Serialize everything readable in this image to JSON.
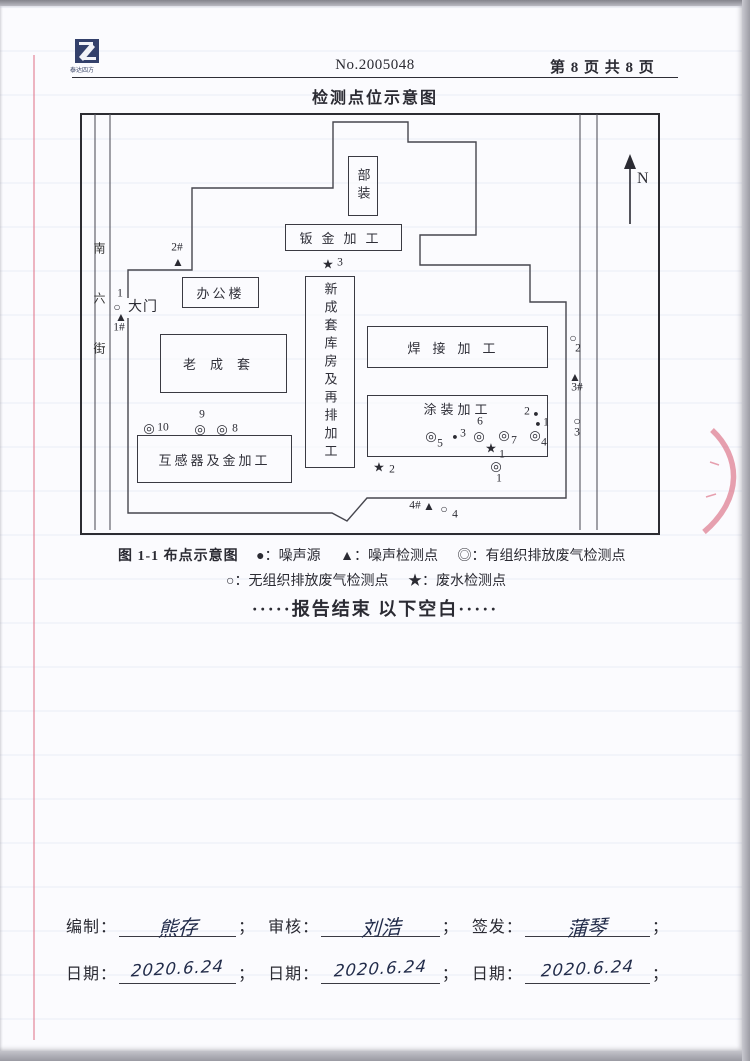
{
  "header": {
    "logo_text": "泰达四方",
    "doc_no": "No.2005048",
    "page_info": "第 8 页 共 8 页",
    "title": "检测点位示意图"
  },
  "diagram": {
    "north_label": "N",
    "street_name": "南六街",
    "gate_label": "大门",
    "symbols": {
      "noise_source": "●",
      "noise_point": "▲",
      "organized_gas": "◎",
      "unorganized_gas": "○",
      "wastewater": "★"
    },
    "buildings": [
      {
        "id": "buzhuang",
        "label": "部装",
        "x": 348,
        "y": 156,
        "w": 30,
        "h": 60,
        "vertical": true
      },
      {
        "id": "banjin",
        "label": "钣金加工",
        "x": 285,
        "y": 224,
        "w": 117,
        "h": 27,
        "spacing": 9
      },
      {
        "id": "bangonglou",
        "label": "办公楼",
        "x": 182,
        "y": 277,
        "w": 77,
        "h": 31,
        "spacing": 3
      },
      {
        "id": "xinchengtao",
        "label": "新成套库房及再排加工",
        "x": 305,
        "y": 276,
        "w": 50,
        "h": 192,
        "vertical": true
      },
      {
        "id": "laochengtao",
        "label": "老成套",
        "x": 160,
        "y": 334,
        "w": 127,
        "h": 59,
        "spacing": 14
      },
      {
        "id": "hanjie",
        "label": "焊接加工",
        "x": 367,
        "y": 326,
        "w": 181,
        "h": 42,
        "spacing": 12
      },
      {
        "id": "tuzhuang",
        "label": "涂装加工",
        "x": 367,
        "y": 395,
        "w": 181,
        "h": 62,
        "spacing": 4,
        "labelPos": "top"
      },
      {
        "id": "huganqi",
        "label": "互感器及金加工",
        "x": 137,
        "y": 435,
        "w": 155,
        "h": 48,
        "spacing": 3
      }
    ],
    "markers": [
      {
        "type": "noise_point",
        "x": 178,
        "y": 262,
        "label": "2#",
        "lx": -1,
        "ly": -14
      },
      {
        "type": "unorganized_gas",
        "x": 117,
        "y": 307,
        "label": "1",
        "lx": 3,
        "ly": -13
      },
      {
        "type": "noise_point",
        "x": 121,
        "y": 317,
        "label": "1#",
        "lx": -2,
        "ly": 11
      },
      {
        "type": "wastewater",
        "x": 328,
        "y": 264,
        "label": "3",
        "lx": 12,
        "ly": -1
      },
      {
        "type": "unorganized_gas",
        "x": 573,
        "y": 338,
        "label": "2",
        "lx": 5,
        "ly": 11
      },
      {
        "type": "noise_point",
        "x": 575,
        "y": 377,
        "label": "3#",
        "lx": 2,
        "ly": 11
      },
      {
        "type": "unorganized_gas",
        "x": 577,
        "y": 421,
        "label": "3",
        "lx": 0,
        "ly": 12
      },
      {
        "type": "noise_source",
        "x": 536,
        "y": 414,
        "label": "2",
        "lx": -9,
        "ly": -2
      },
      {
        "type": "noise_source",
        "x": 538,
        "y": 424,
        "label": "1",
        "lx": 8,
        "ly": -1
      },
      {
        "type": "organized_gas",
        "x": 431,
        "y": 436,
        "label": "5",
        "lx": 9,
        "ly": 8
      },
      {
        "type": "noise_source",
        "x": 455,
        "y": 437,
        "label": "3",
        "lx": 8,
        "ly": -3
      },
      {
        "type": "organized_gas",
        "x": 479,
        "y": 436,
        "label": "6",
        "lx": 1,
        "ly": -14
      },
      {
        "type": "organized_gas",
        "x": 504,
        "y": 435,
        "label": "7",
        "lx": 10,
        "ly": 6
      },
      {
        "type": "organized_gas",
        "x": 535,
        "y": 435,
        "label": "4",
        "lx": 9,
        "ly": 8
      },
      {
        "type": "wastewater",
        "x": 491,
        "y": 448,
        "label": "1",
        "lx": 11,
        "ly": 7
      },
      {
        "type": "wastewater",
        "x": 379,
        "y": 467,
        "label": "2",
        "lx": 13,
        "ly": 3
      },
      {
        "type": "organized_gas",
        "x": 496,
        "y": 466,
        "label": "1",
        "lx": 3,
        "ly": 13
      },
      {
        "type": "organized_gas",
        "x": 149,
        "y": 428,
        "label": "10",
        "lx": 14,
        "ly": 0
      },
      {
        "type": "organized_gas",
        "x": 200,
        "y": 429,
        "label": "9",
        "lx": 2,
        "ly": -14
      },
      {
        "type": "organized_gas",
        "x": 222,
        "y": 429,
        "label": "8",
        "lx": 13,
        "ly": 0
      },
      {
        "type": "noise_point",
        "x": 429,
        "y": 506,
        "label": "4#",
        "lx": -14,
        "ly": 0
      },
      {
        "type": "unorganized_gas",
        "x": 444,
        "y": 509,
        "label": "4",
        "lx": 11,
        "ly": 6
      }
    ]
  },
  "legend": {
    "caption": "图 1-1 布点示意图",
    "items": [
      "●：噪声源",
      "▲：噪声检测点",
      "◎：有组织排放废气检测点",
      "○：无组织排放废气检测点",
      "★：废水检测点"
    ]
  },
  "end_note": "·····报告结束 以下空白·····",
  "signatures": {
    "prepared_label": "编制：",
    "prepared_value": "熊存",
    "reviewed_label": "审核：",
    "reviewed_value": "刘浩",
    "issued_label": "签发：",
    "issued_value": "蒲琴",
    "date_label": "日期：",
    "date1": "2020.6.24",
    "date2": "2020.6.24",
    "date3": "2020.6.24",
    "separator": "；"
  },
  "colors": {
    "ink": "#2b2b33",
    "stamp_red": "#d6556e",
    "margin_line_pink": "#df6e84"
  }
}
